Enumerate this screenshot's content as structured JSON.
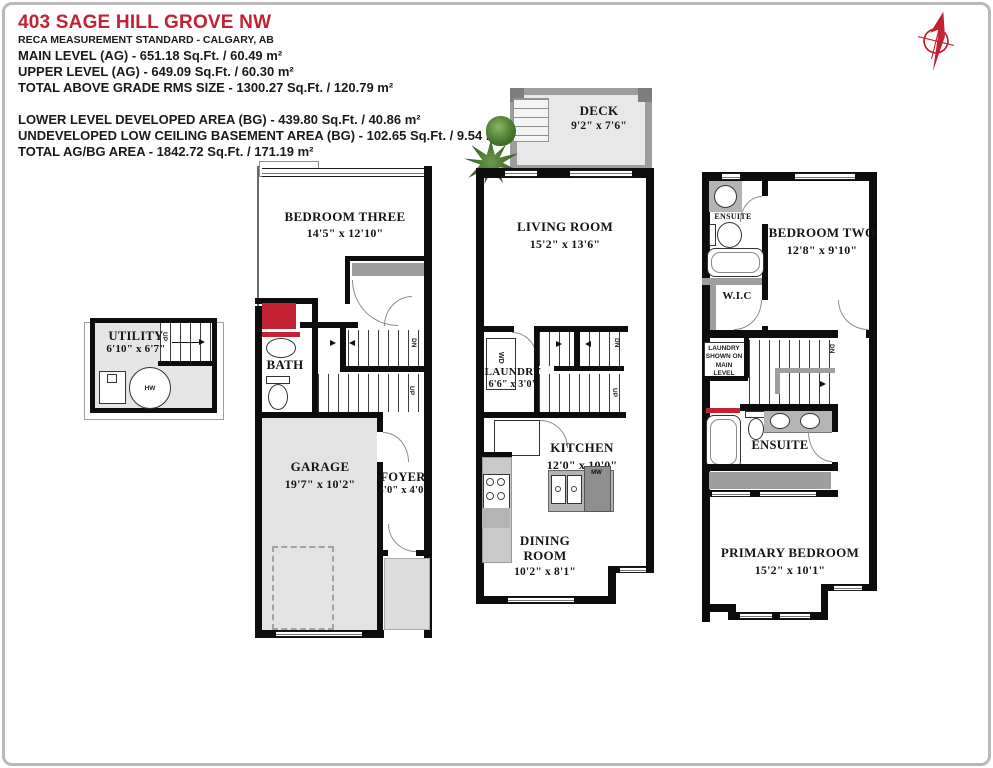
{
  "header": {
    "title": "403 SAGE HILL GROVE NW",
    "standard": "RECA MEASUREMENT STANDARD - CALGARY, AB",
    "above_grade": [
      "MAIN LEVEL (AG) - 651.18 Sq.Ft. / 60.49 m²",
      "UPPER LEVEL (AG) - 649.09 Sq.Ft. / 60.30 m²",
      "TOTAL ABOVE GRADE RMS SIZE - 1300.27 Sq.Ft. / 120.79 m²"
    ],
    "below_grade": [
      "LOWER LEVEL DEVELOPED AREA (BG) - 439.80 Sq.Ft. / 40.86 m²",
      "UNDEVELOPED LOW CEILING BASEMENT AREA (BG) - 102.65 Sq.Ft. / 9.54 m²",
      "TOTAL AG/BG AREA - 1842.72 Sq.Ft. / 171.19 m²"
    ]
  },
  "colors": {
    "accent_red": "#c22233",
    "wall_black": "#0d0d0d",
    "room_fill_gray": "#e5e5e5",
    "counter_gray": "#b4b4b4",
    "plant_green": "#3f6d28"
  },
  "lower_level": {
    "utility": {
      "name": "UTILITY",
      "dims": "6'10\" x 6'7\""
    },
    "hot_water_label": "HW",
    "stairs_up_label": "UP",
    "bedroom_three": {
      "name": "BEDROOM THREE",
      "dims": "14'5\" x 12'10\""
    },
    "bath": {
      "name": "BATH"
    },
    "stairs_dn_label": "DN",
    "stairs_up2_label": "UP",
    "garage": {
      "name": "GARAGE",
      "dims": "19'7\" x 10'2\""
    },
    "foyer": {
      "name": "FOYER",
      "dims": "4'0\" x 4'0\""
    }
  },
  "main_level": {
    "deck": {
      "name": "DECK",
      "dims": "9'2\" x 7'6\""
    },
    "living_room": {
      "name": "LIVING ROOM",
      "dims": "15'2\" x 13'6\""
    },
    "washer_dryer_label": "WD",
    "laundry": {
      "name": "LAUNDRY",
      "dims": "6'6\" x 3'0\""
    },
    "stairs_dn_label": "DN",
    "stairs_up_label": "UP",
    "kitchen": {
      "name": "KITCHEN",
      "dims": "12'0\" x 10'0\""
    },
    "microwave_label": "MW",
    "dining_room": {
      "name": "DINING ROOM",
      "dims": "10'2\" x 8'1\""
    }
  },
  "upper_level": {
    "ensuite_two": {
      "name": "ENSUITE"
    },
    "bedroom_two": {
      "name": "BEDROOM TWO",
      "dims": "12'8\" x 9'10\""
    },
    "wic": {
      "name": "W.I.C"
    },
    "laundry_note": "LAUNDRY SHOWN ON MAIN LEVEL",
    "stairs_dn_label": "DN",
    "primary_ensuite": {
      "name": "ENSUITE"
    },
    "primary_bedroom": {
      "name": "PRIMARY BEDROOM",
      "dims": "15'2\" x 10'1\""
    }
  }
}
